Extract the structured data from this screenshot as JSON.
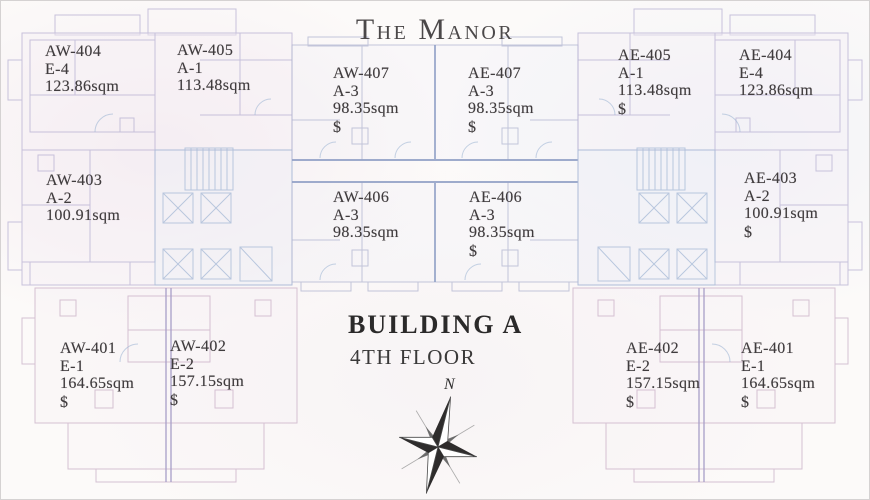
{
  "title": "The Manor",
  "title_words": [
    "The",
    "Manor"
  ],
  "plan": {
    "building": "BUILDING A",
    "floor": "4TH FLOOR",
    "compass_label": "N"
  },
  "units": [
    {
      "id": "AW-404",
      "type": "E-4",
      "area": "123.86sqm"
    },
    {
      "id": "AW-405",
      "type": "A-1",
      "area": "113.48sqm"
    },
    {
      "id": "AW-407",
      "type": "A-3",
      "area": "98.35sqm",
      "price": "$"
    },
    {
      "id": "AE-407",
      "type": "A-3",
      "area": "98.35sqm",
      "price": "$"
    },
    {
      "id": "AE-405",
      "type": "A-1",
      "area": "113.48sqm",
      "price": "$"
    },
    {
      "id": "AE-404",
      "type": "E-4",
      "area": "123.86sqm"
    },
    {
      "id": "AW-403",
      "type": "A-2",
      "area": "100.91sqm"
    },
    {
      "id": "AW-406",
      "type": "A-3",
      "area": "98.35sqm"
    },
    {
      "id": "AE-406",
      "type": "A-3",
      "area": "98.35sqm",
      "price": "$"
    },
    {
      "id": "AE-403",
      "type": "A-2",
      "area": "100.91sqm",
      "price": "$"
    },
    {
      "id": "AW-401",
      "type": "E-1",
      "area": "164.65sqm",
      "price": "$"
    },
    {
      "id": "AW-402",
      "type": "E-2",
      "area": "157.15sqm",
      "price": "$"
    },
    {
      "id": "AE-402",
      "type": "E-2",
      "area": "157.15sqm",
      "price": "$"
    },
    {
      "id": "AE-401",
      "type": "E-1",
      "area": "164.65sqm",
      "price": "$"
    }
  ],
  "colors": {
    "ink": "#403c3e",
    "line_lavender": "#b7b0d2",
    "line_blue": "#a9bcd8",
    "line_pink": "#c9aec6"
  }
}
